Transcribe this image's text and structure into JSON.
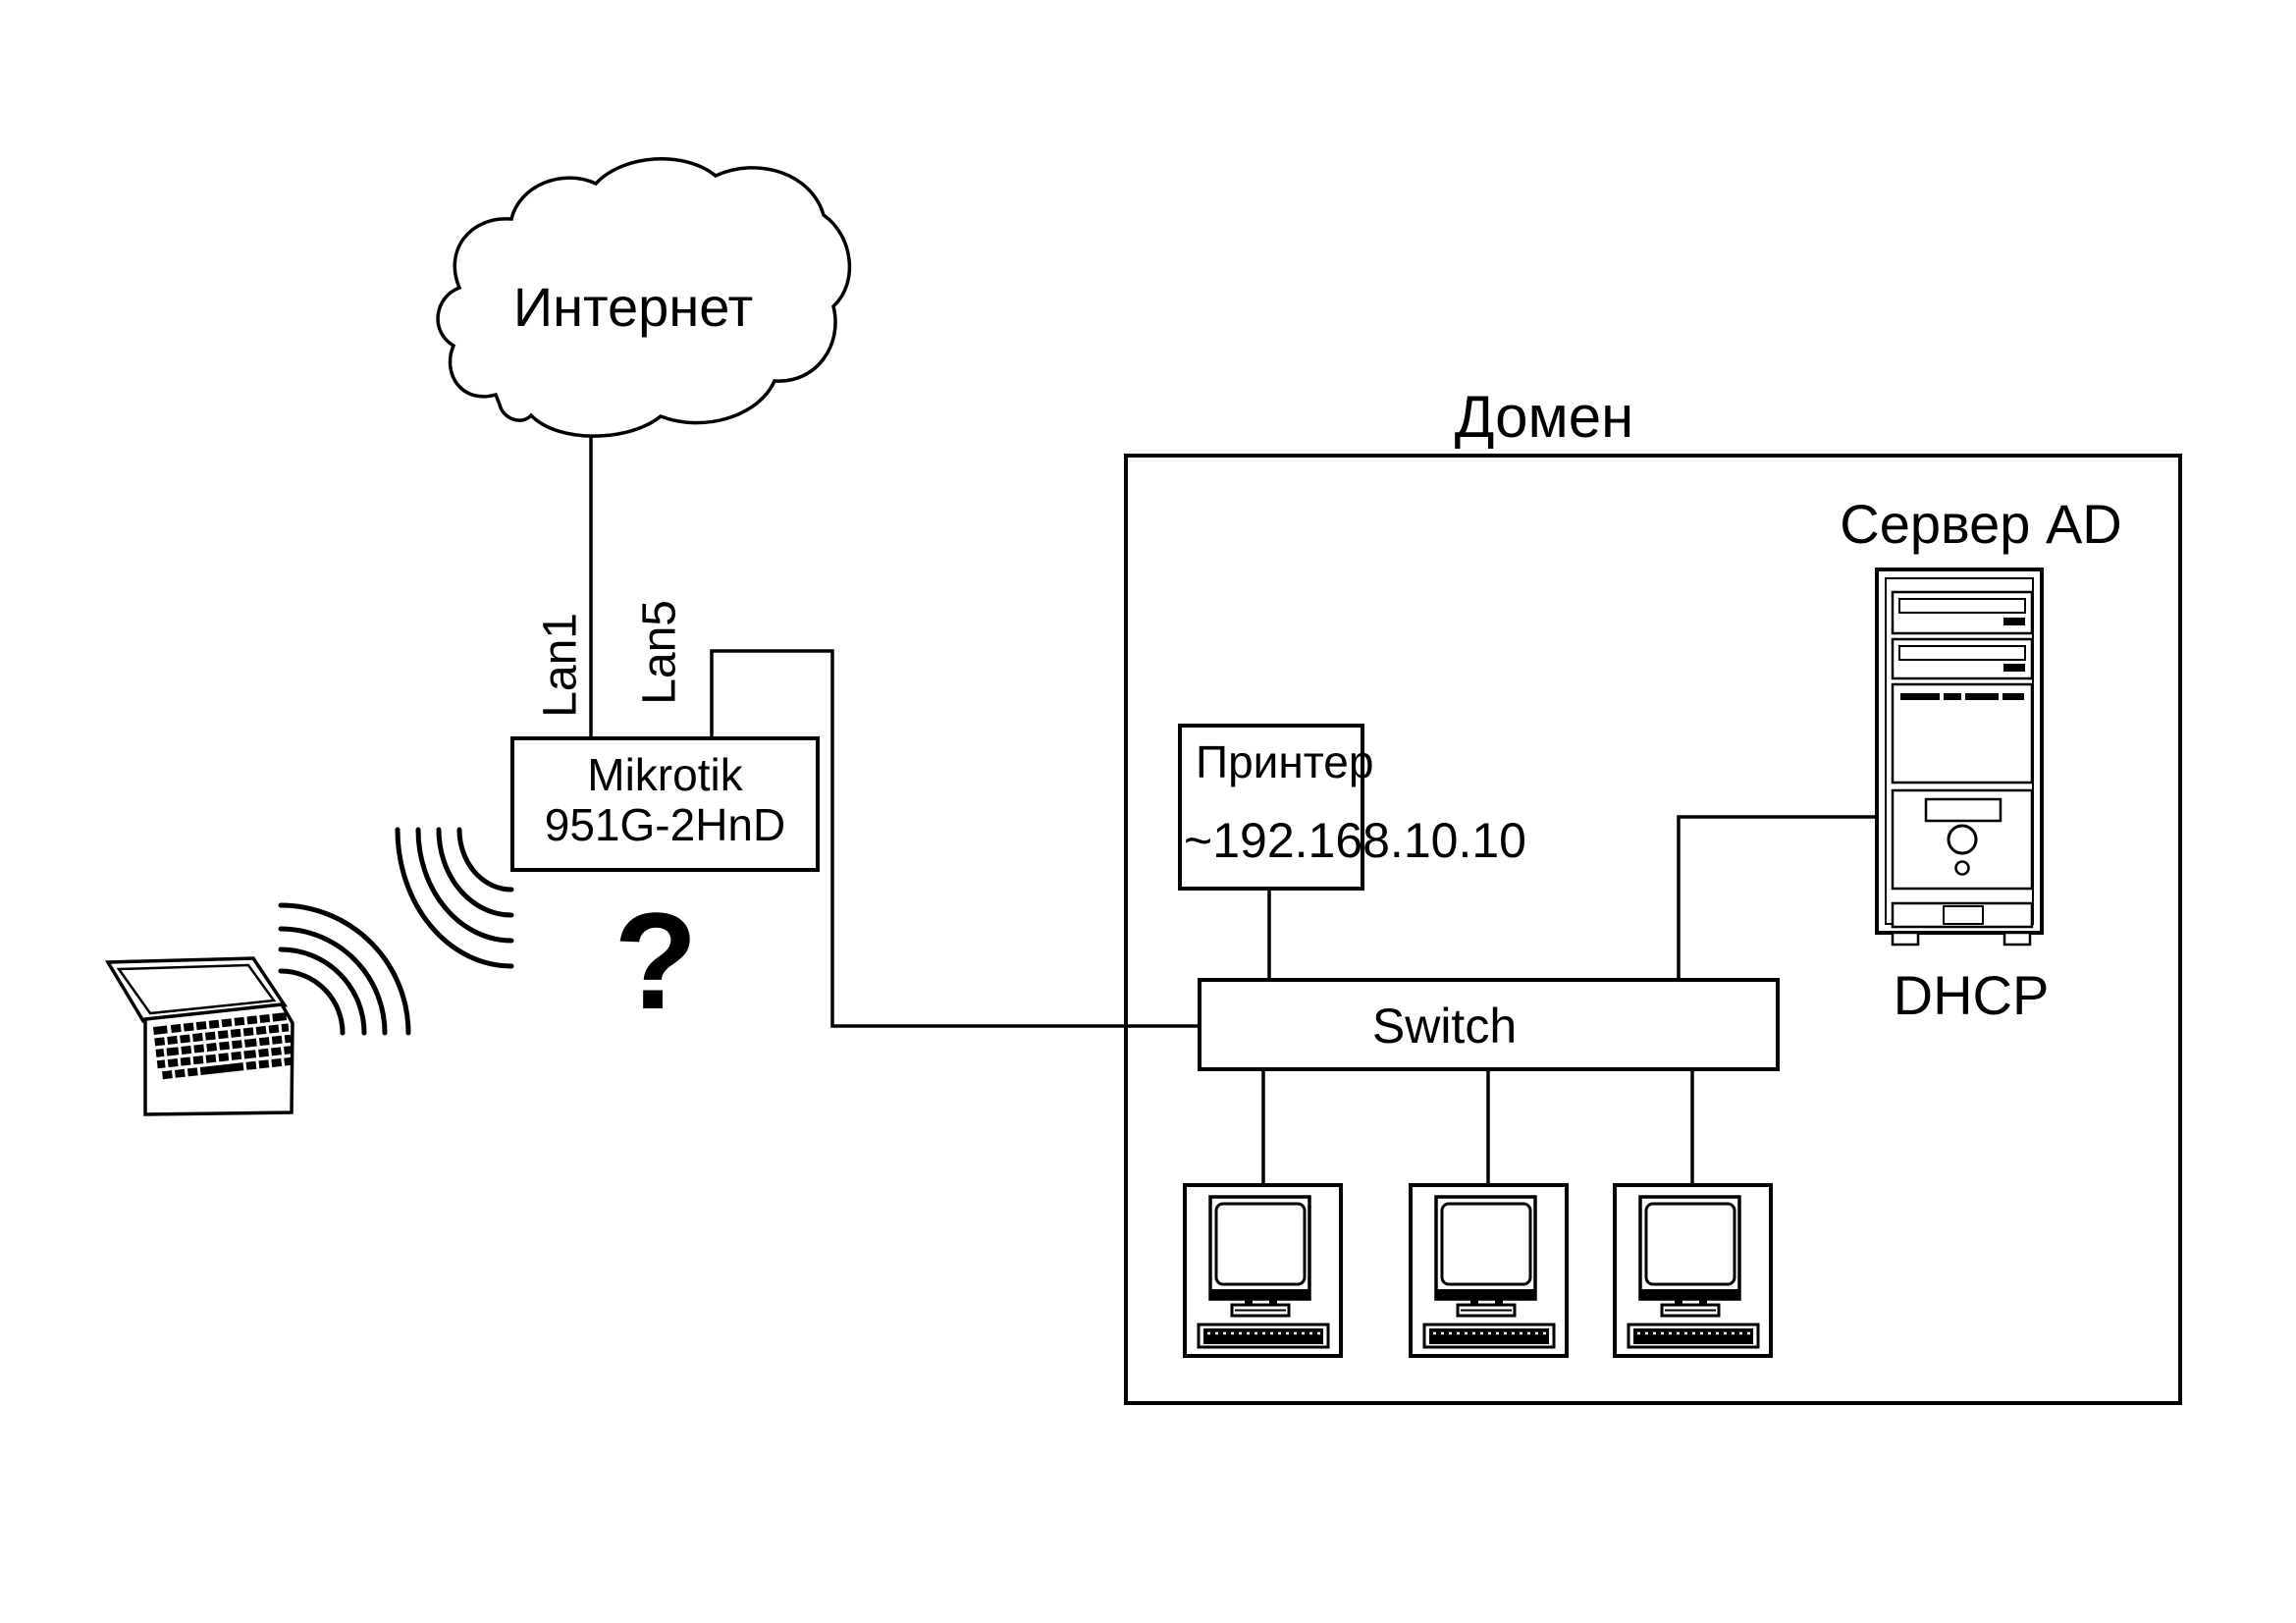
{
  "internet": {
    "label": "Интернет",
    "icon": "cloud-icon"
  },
  "router": {
    "model_line1": "Mikrotik",
    "model_line2": "951G-2HnD",
    "port_wan_label": "Lan1",
    "port_lan_label": "Lan5"
  },
  "wireless": {
    "question_label": "?",
    "laptop_icon": "laptop-icon",
    "signal_icon": "wifi-waves-icon"
  },
  "domain": {
    "label": "Домен"
  },
  "printer": {
    "name": "Принтер",
    "address": "~192.168.10.10"
  },
  "switch": {
    "label": "Switch"
  },
  "server": {
    "title": "Сервер AD",
    "role": "DHCP",
    "icon": "server-tower-icon"
  },
  "workstations": {
    "count": 3,
    "icon": "desktop-computer-icon"
  },
  "colors": {
    "ink": "#000000",
    "background": "#ffffff"
  }
}
